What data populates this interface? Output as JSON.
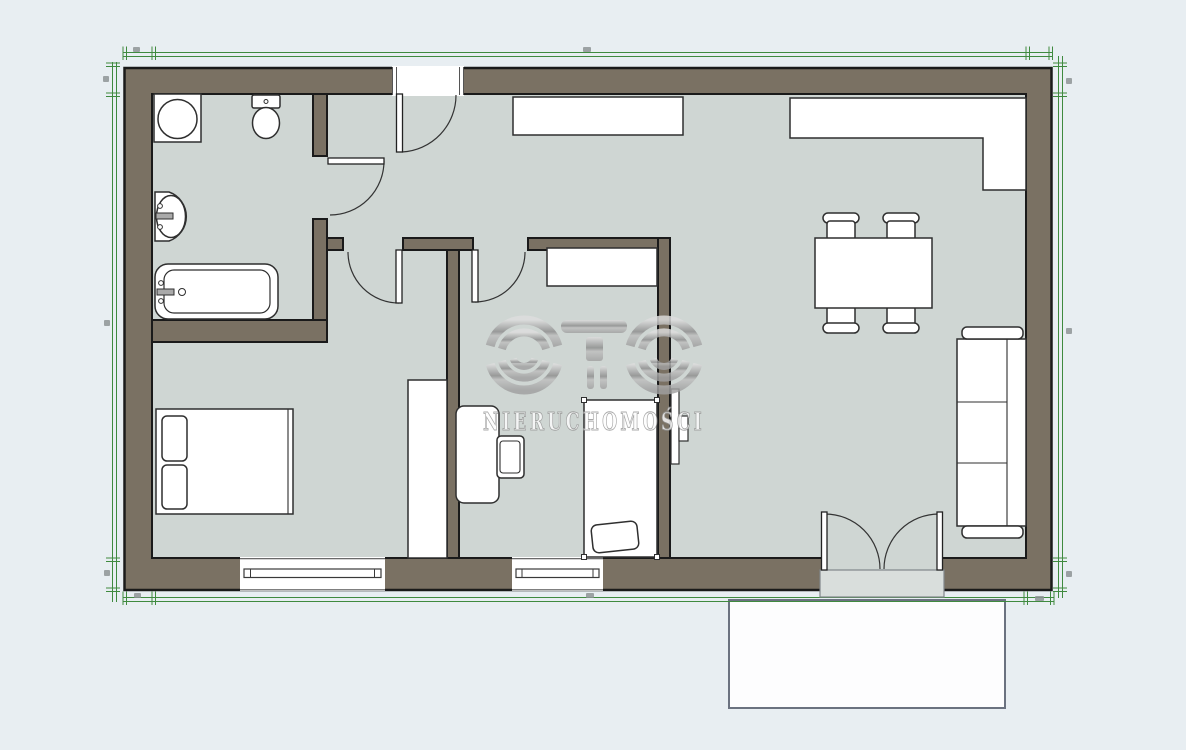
{
  "watermark": {
    "logo_text": "OTO",
    "subtitle": "NIERUCHOMOŚCI"
  },
  "palette": {
    "bg": "#e8eef2",
    "floor": "#cfd6d3",
    "wall": "#7a7163",
    "outline": "#1a1a1a",
    "furniture": "#ffffff",
    "furniture_line": "#2f2f2f",
    "dim": "#3f8a3f",
    "dim_label": "#8e9496",
    "terrace": "#fdfdfe",
    "terrace_border": "#6b7280",
    "threshold": "#d9dedc",
    "wm_light": "#dedede",
    "wm_dark": "#8d8d8d",
    "wm_text_fill": "#fdfdfd",
    "wm_text_stroke": "#979797"
  }
}
